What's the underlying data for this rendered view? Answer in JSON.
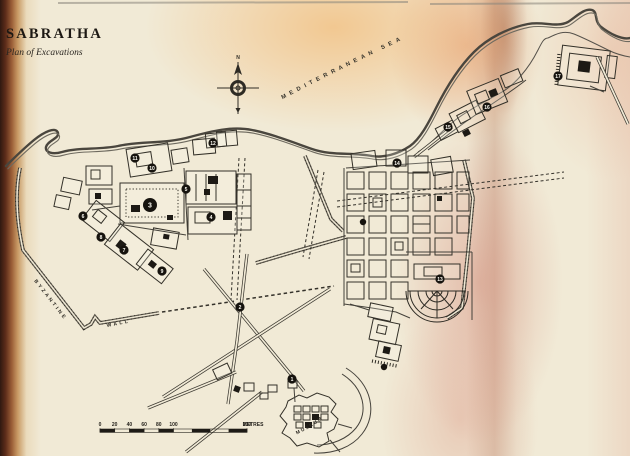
{
  "header": {
    "title": "SABRATHA",
    "subtitle": "Plan of Excavations"
  },
  "map": {
    "sea_label": "MEDITERRANEAN SEA",
    "byzantine_wall_label_line1": "BYZANTINE",
    "byzantine_wall_label_line2": "WALL",
    "museum_label": "MUSEUM",
    "compass_north_label": "N",
    "markers": [
      {
        "n": "1",
        "x": 292,
        "y": 379
      },
      {
        "n": "2",
        "x": 240,
        "y": 307
      },
      {
        "n": "3",
        "x": 150,
        "y": 205,
        "big": true
      },
      {
        "n": "4",
        "x": 211,
        "y": 217
      },
      {
        "n": "5",
        "x": 186,
        "y": 189
      },
      {
        "n": "6",
        "x": 83,
        "y": 216
      },
      {
        "n": "7",
        "x": 124,
        "y": 250
      },
      {
        "n": "8",
        "x": 101,
        "y": 237
      },
      {
        "n": "9",
        "x": 162,
        "y": 271
      },
      {
        "n": "10",
        "x": 152,
        "y": 168
      },
      {
        "n": "11",
        "x": 135,
        "y": 158
      },
      {
        "n": "12",
        "x": 213,
        "y": 143
      },
      {
        "n": "13",
        "x": 440,
        "y": 279
      },
      {
        "n": "14",
        "x": 397,
        "y": 163
      },
      {
        "n": "15",
        "x": 448,
        "y": 127
      },
      {
        "n": "16",
        "x": 487,
        "y": 107
      },
      {
        "n": "17",
        "x": 558,
        "y": 76
      },
      {
        "n": "",
        "x": 363,
        "y": 222
      },
      {
        "n": "",
        "x": 384,
        "y": 367
      }
    ],
    "scale_bar": {
      "tick_values": [
        "0",
        "20",
        "40",
        "60",
        "80",
        "100"
      ],
      "end_value": "200",
      "unit": "METRES"
    },
    "colors": {
      "paper": "#f1ead6",
      "ink": "#2e2b24",
      "binding_edge": "#5e2d1a",
      "fold_blush": "#c97f6d"
    }
  }
}
